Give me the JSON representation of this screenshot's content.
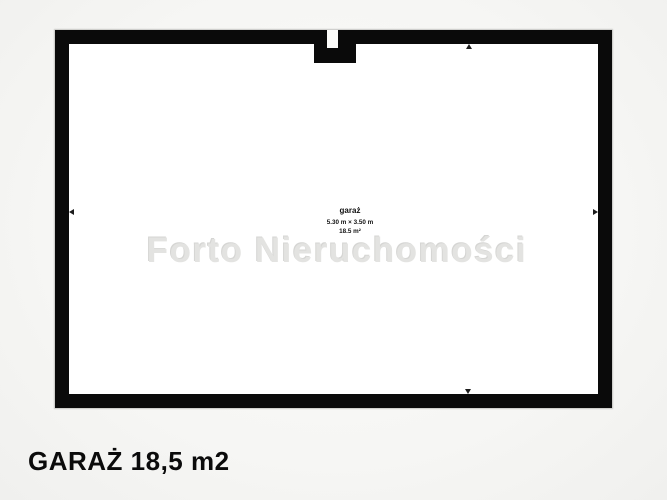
{
  "plan": {
    "room": {
      "name": "garaż",
      "dimensions": "5.30 m × 3.50 m",
      "area": "18.5 m²"
    },
    "watermark": "Forto Nieruchomości",
    "title": "GARAŻ 18,5 m2",
    "colors": {
      "wall": "#0a0a0a",
      "interior": "#ffffff",
      "background": "#f6f6f4",
      "watermark_text": "#e3e3e1",
      "label_text": "#111111",
      "title_text": "#0b0b0b"
    }
  }
}
